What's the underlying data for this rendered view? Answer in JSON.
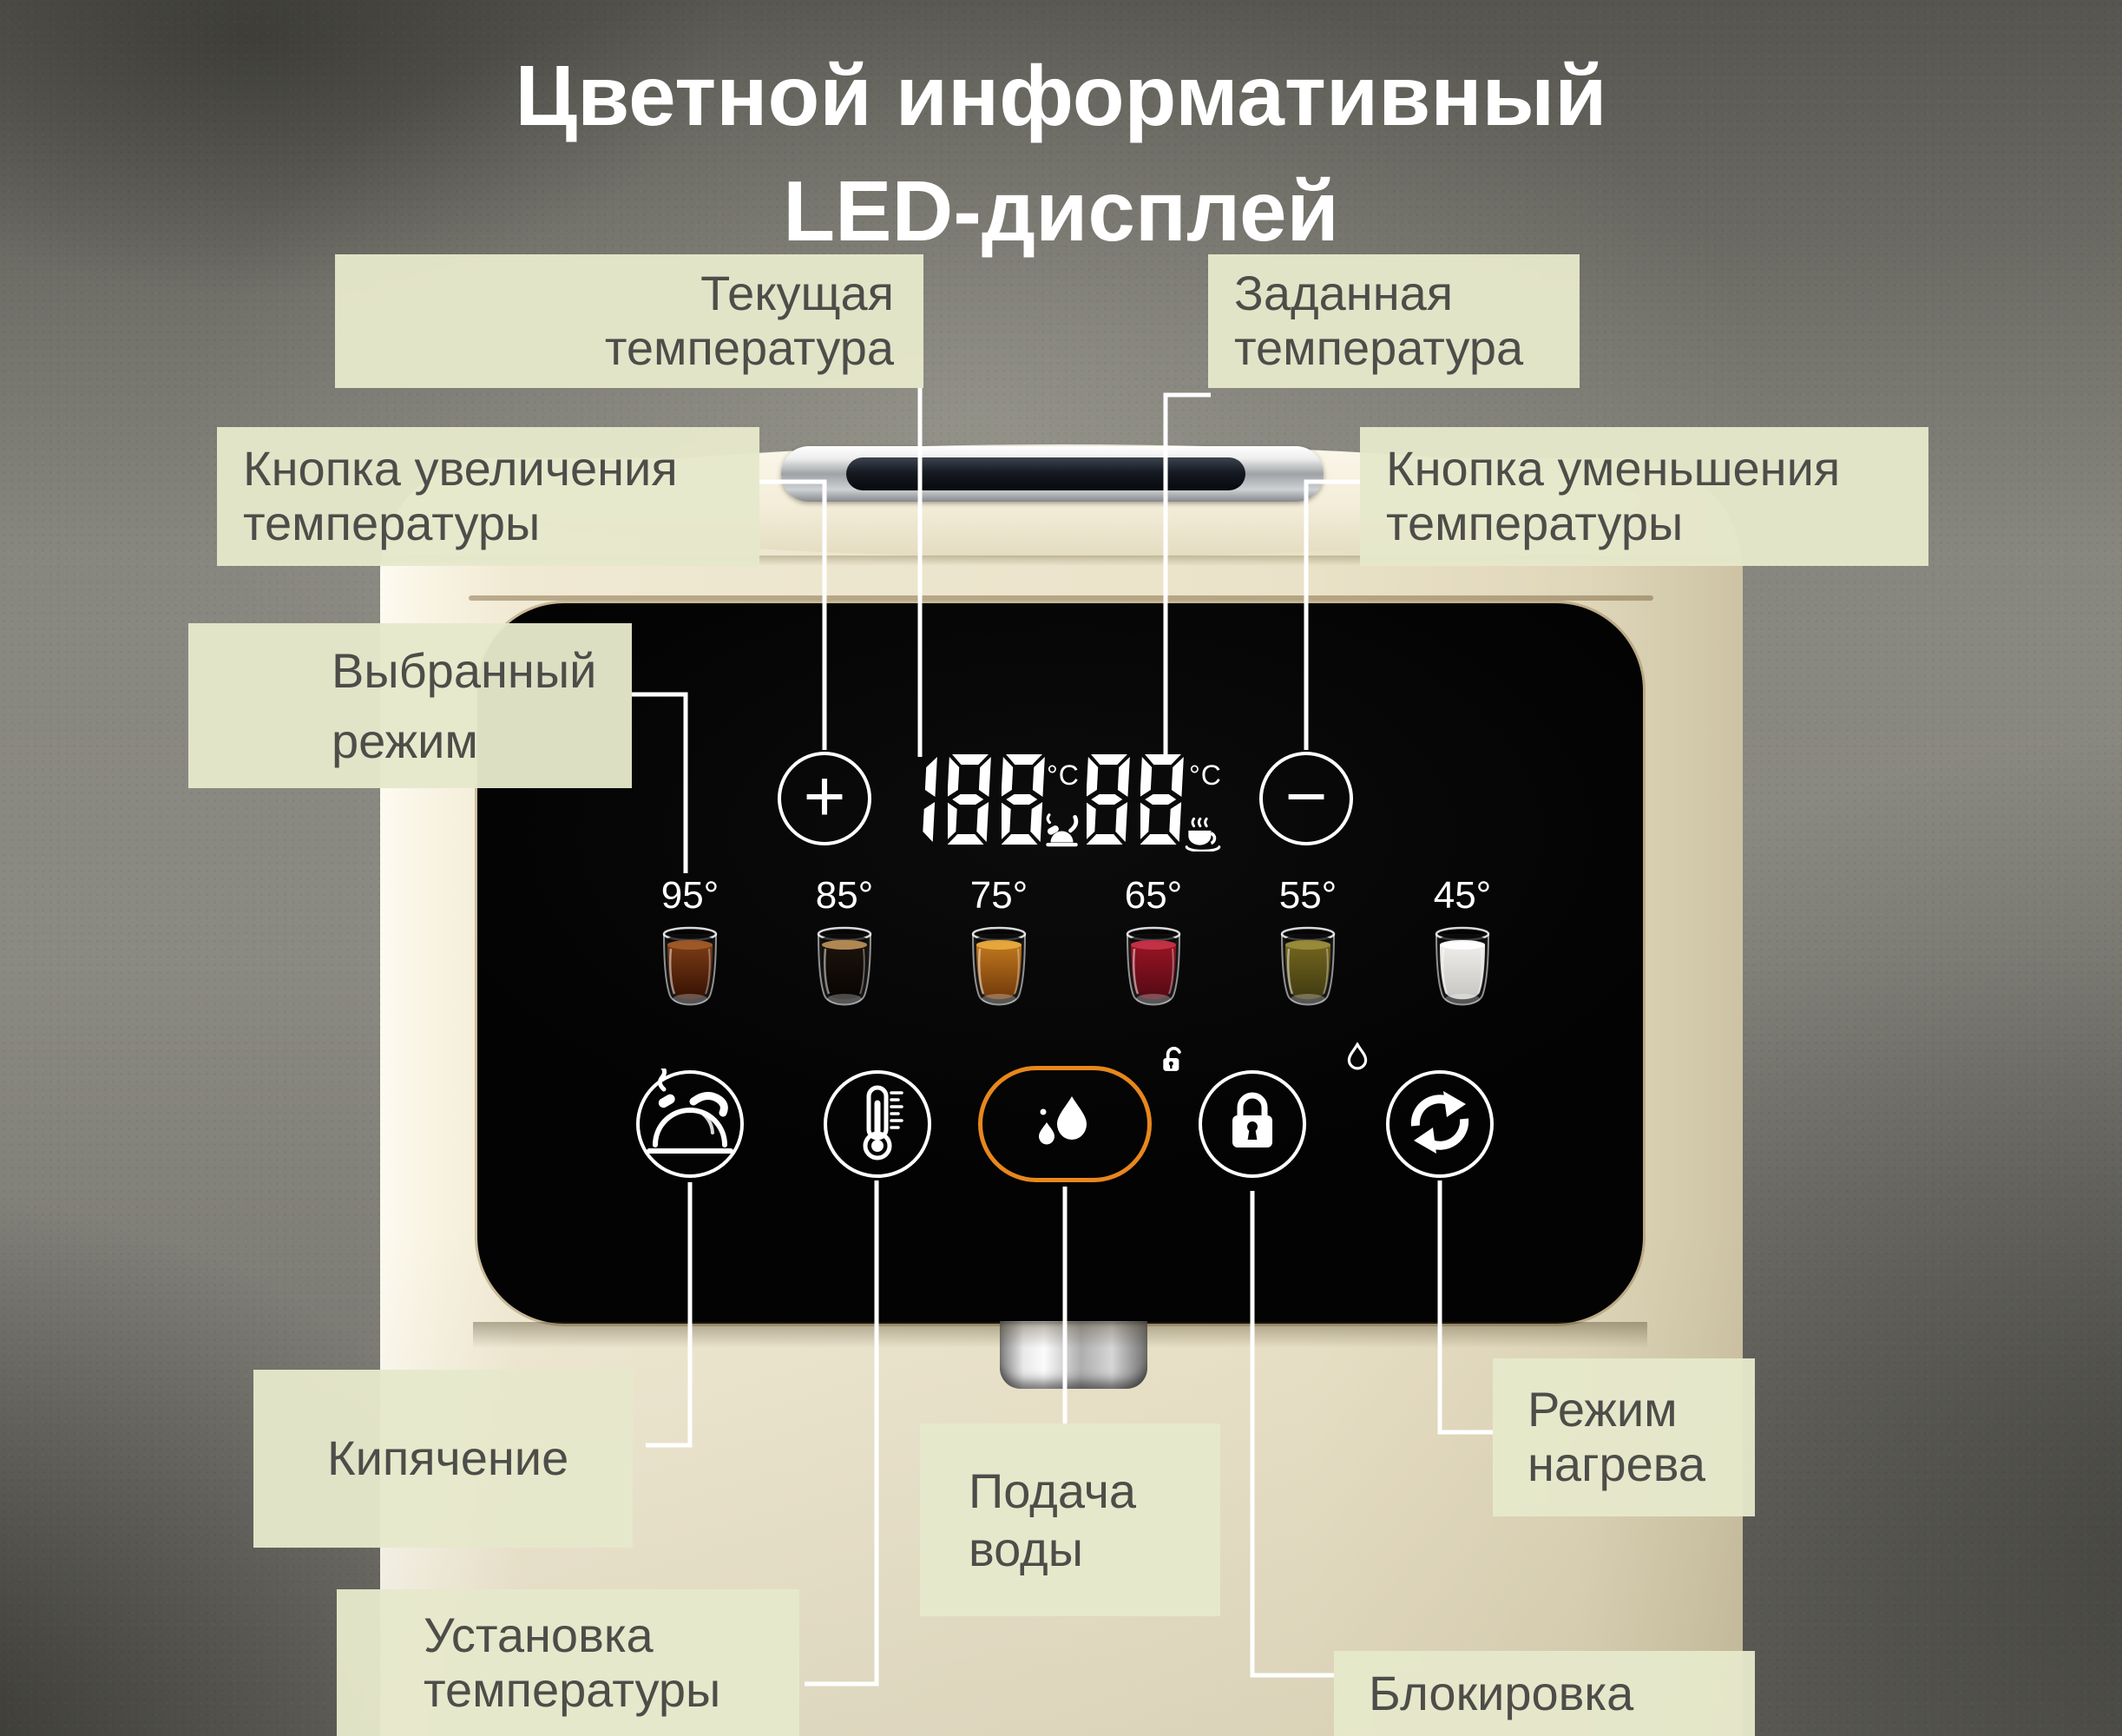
{
  "title": {
    "line1": "Цветной информативный",
    "line2": "LED-дисплей"
  },
  "labels": {
    "current_temp": "Текущая\nтемпература",
    "set_temp": "Заданная\nтемпература",
    "increase": "Кнопка увеличения\nтемпературы",
    "decrease": "Кнопка уменьшения\nтемпературы",
    "selected_mode": "Выбранный\nрежим",
    "boil": "Кипячение",
    "temp_setting": "Установка\nтемпературы",
    "water_supply": "Подача\nводы",
    "heat_mode": "Режим\nнагрева",
    "lock": "Блокировка"
  },
  "display": {
    "current_value": "188",
    "set_value": "88",
    "unit_current": "°C",
    "unit_set": "°C",
    "plus": "+",
    "minus": "−"
  },
  "presets": [
    {
      "label": "95°",
      "drink": "black-tea",
      "surface": "#a05a28",
      "body_top": "#7e3d16",
      "body_bottom": "#351103"
    },
    {
      "label": "85°",
      "drink": "coffee",
      "surface": "#b98e55",
      "body_top": "#1d130c",
      "body_bottom": "#070403"
    },
    {
      "label": "75°",
      "drink": "amber-tea",
      "surface": "#e8a93e",
      "body_top": "#c47a1e",
      "body_bottom": "#70380b"
    },
    {
      "label": "65°",
      "drink": "hibiscus",
      "surface": "#c43348",
      "body_top": "#9c1424",
      "body_bottom": "#520a14"
    },
    {
      "label": "55°",
      "drink": "green-tea",
      "surface": "#9a8c3a",
      "body_top": "#75671f",
      "body_bottom": "#403a10"
    },
    {
      "label": "45°",
      "drink": "water",
      "surface": "#ffffff",
      "body_top": "#f0efec",
      "body_bottom": "#c6c5c2"
    }
  ],
  "mode_buttons": [
    {
      "name": "boil",
      "icon": "kettle-icon",
      "highlighted": false
    },
    {
      "name": "temp-setting",
      "icon": "thermometer-icon",
      "highlighted": false
    },
    {
      "name": "water-supply",
      "icon": "water-drops-icon",
      "highlighted": true
    },
    {
      "name": "child-lock",
      "icon": "lock-icon",
      "highlighted": false
    },
    {
      "name": "heat-mode",
      "icon": "cycle-icon",
      "highlighted": false
    }
  ],
  "colors": {
    "accent": "#e8871c",
    "line": "#ffffff",
    "label_bg": "#e6e8cb",
    "label_text": "#4d4d49",
    "panel": "#050505",
    "digit": "#ffffff"
  }
}
